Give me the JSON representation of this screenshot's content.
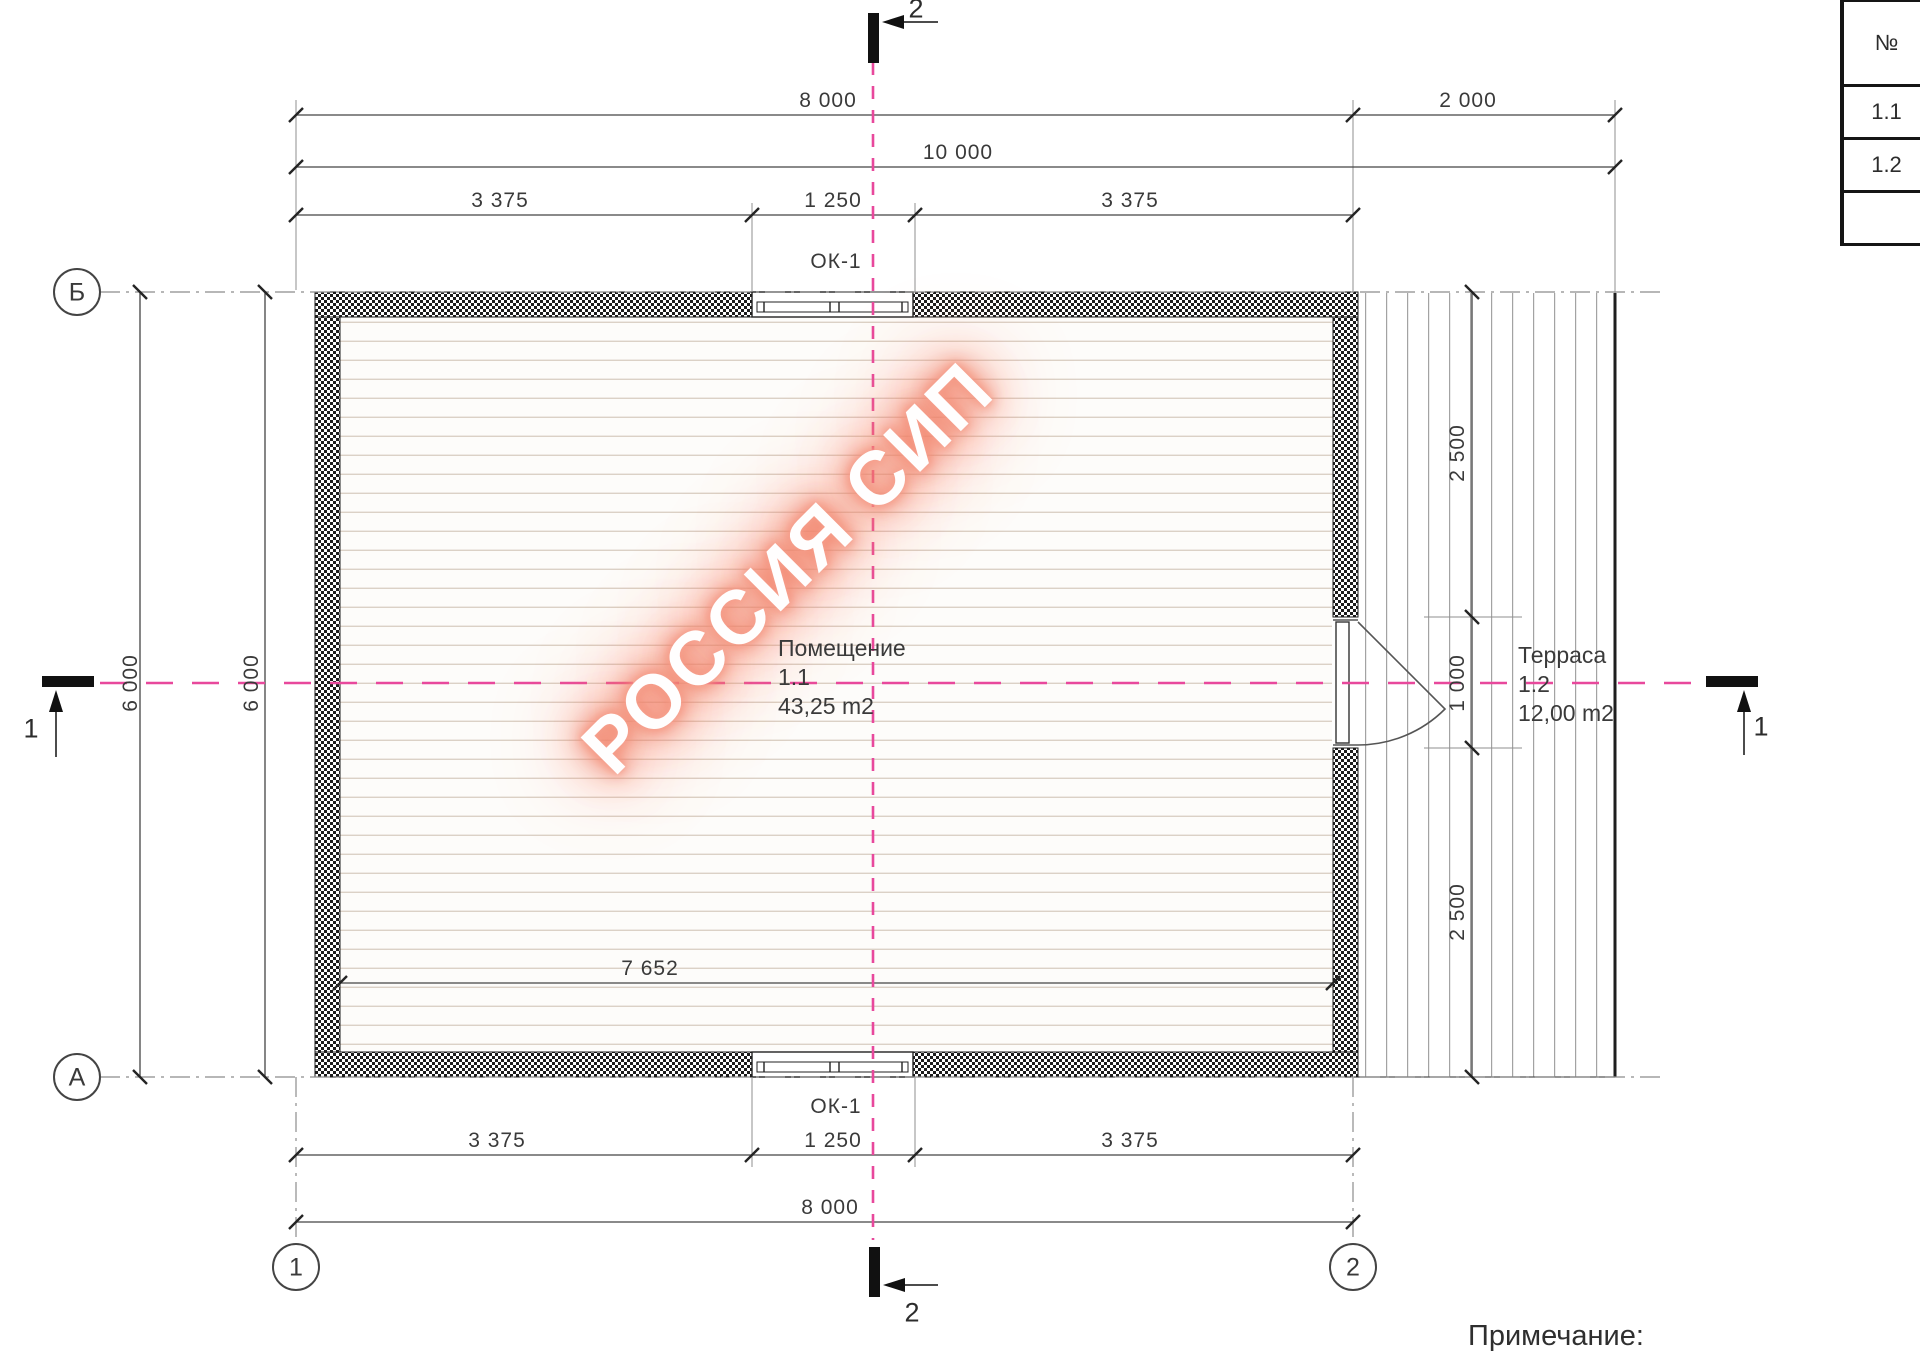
{
  "watermark": "РОССИЯ СИП",
  "note": "Примечание:",
  "colors": {
    "centerline": "#e8489c",
    "line": "#3a3a3a",
    "watermark_glow": "#f07a60"
  },
  "table": {
    "header": "№",
    "rows": [
      "1.1",
      "1.2",
      ""
    ]
  },
  "axis": {
    "b": "Б",
    "a": "А",
    "one": "1",
    "two": "2"
  },
  "section": {
    "one_left": "1",
    "one_right": "1",
    "two_top": "2",
    "two_bottom": "2"
  },
  "windows": {
    "top": "ОК-1",
    "bottom": "ОК-1"
  },
  "rooms": {
    "main": {
      "name": "Помещение",
      "number": "1.1",
      "area": "43,25 m2"
    },
    "terrace": {
      "name": "Терраса",
      "number": "1.2",
      "area": "12,00 m2"
    }
  },
  "dims": {
    "top1a": "8 000",
    "top1b": "2 000",
    "top2": "10 000",
    "top3a": "3 375",
    "top3b": "1 250",
    "top3c": "3 375",
    "bot1a": "3 375",
    "bot1b": "1 250",
    "bot1c": "3 375",
    "bot2": "8 000",
    "left_outer": "6 000",
    "left_inner": "6 000",
    "right_top": "2 500",
    "right_mid": "1 000",
    "right_bottom": "2 500",
    "interior": "7 652"
  }
}
